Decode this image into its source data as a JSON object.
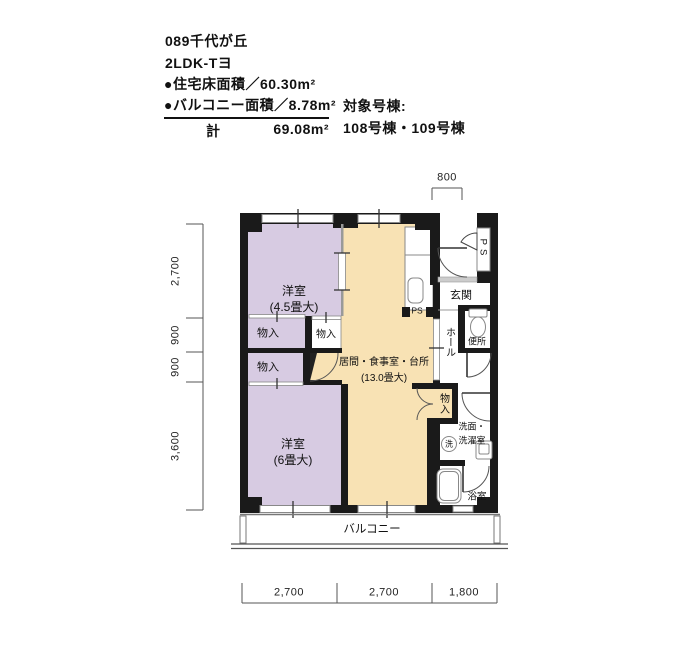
{
  "header": {
    "code_title": "089千代が丘",
    "plan_type": "2LDK-Tヨ",
    "floor_area": "●住宅床面積／60.30m²",
    "balcony_area": "●バルコニー面積／8.78m²",
    "total_label": "計",
    "total_value": "69.08m²",
    "building_label": "対象号棟:",
    "building_value": "108号棟・109号棟"
  },
  "rooms": {
    "bedroom_small_name": "洋室",
    "bedroom_small_size": "(4.5畳大)",
    "bedroom_large_name": "洋室",
    "bedroom_large_size": "(6畳大)",
    "ldk_name": "居間・食事室・台所",
    "ldk_size": "(13.0畳大)",
    "entrance": "玄関",
    "hall": "ホール",
    "toilet": "便所",
    "washroom_line1": "洗面・",
    "washroom_line2": "洗濯室",
    "bath": "浴室",
    "balcony": "バルコニー",
    "storage": "物入",
    "pipe_space": "PS",
    "washer_mark": "洗"
  },
  "dimensions": {
    "top_width": "800",
    "left": [
      "2,700",
      "900",
      "900",
      "3,600"
    ],
    "bottom": [
      "2,700",
      "2,700",
      "1,800"
    ]
  },
  "colors": {
    "wall": "#1a1a1a",
    "bedroom_fill": "#d7cbe2",
    "ldk_fill": "#f8e2b4",
    "line": "#777777"
  }
}
